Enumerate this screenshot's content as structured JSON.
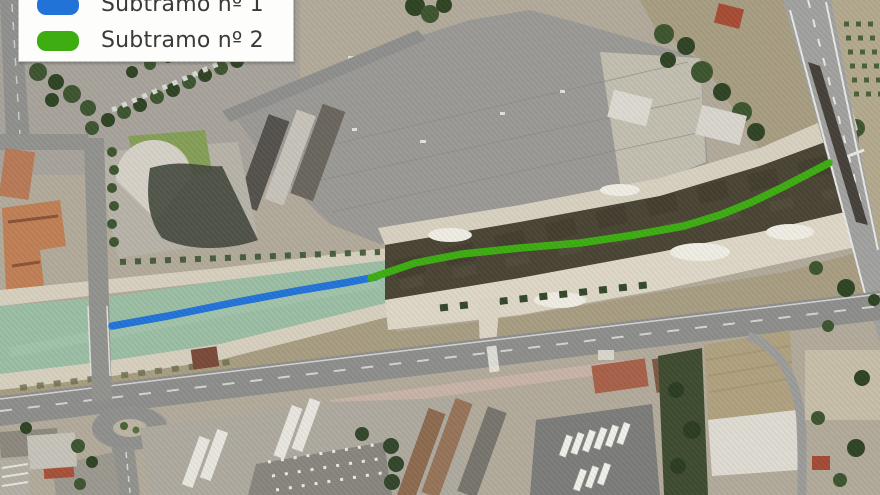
{
  "legend": {
    "items": [
      {
        "id": "subtramo-1",
        "label": "Subtramo nº 1"
      },
      {
        "id": "subtramo-2",
        "label": "Subtramo nº 2"
      }
    ]
  },
  "map": {
    "type": "aerial-satellite-photo",
    "overlay_routes": [
      {
        "id": "subtramo-1",
        "label": "Subtramo nº 1",
        "color": "#2273d8",
        "stroke_width": 7.5,
        "points": [
          [
            112,
            326
          ],
          [
            168,
            316
          ],
          [
            232,
            303
          ],
          [
            296,
            291
          ],
          [
            344,
            283
          ],
          [
            376,
            277
          ]
        ]
      },
      {
        "id": "subtramo-2",
        "label": "Subtramo nº 2",
        "color": "#3dad12",
        "stroke_width": 7.5,
        "points": [
          [
            371,
            278
          ],
          [
            415,
            263
          ],
          [
            462,
            254
          ],
          [
            520,
            248
          ],
          [
            580,
            243
          ],
          [
            634,
            235
          ],
          [
            684,
            226
          ],
          [
            720,
            215
          ],
          [
            752,
            202
          ],
          [
            783,
            187
          ],
          [
            808,
            174
          ],
          [
            829,
            163
          ]
        ]
      }
    ],
    "colors": {
      "canal_water": "#9cbea5",
      "channel_vegetation": "#4a4434",
      "esplanade": "#9b9995",
      "avenue": "#8e8e8c",
      "highway": "#a1a19f",
      "roundabout": "#90908e",
      "sand_bank": "#d8d1c0",
      "terrain_scrub": "#a89d82"
    }
  }
}
